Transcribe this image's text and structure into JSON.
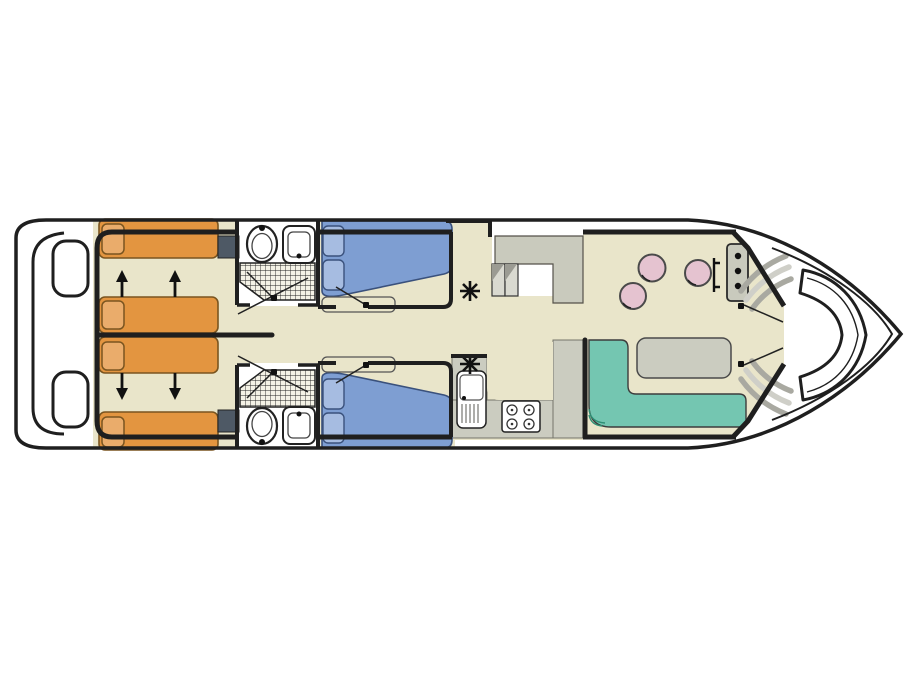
{
  "diagram": {
    "kind": "houseboat-floor-plan",
    "orientation": "bow-right",
    "areas": [
      {
        "name": "stern-swim-platform",
        "features": [
          "platform-inner-rail",
          "boarding-pads"
        ]
      },
      {
        "name": "aft-twin-cabins",
        "bed_count": 4,
        "bed_color_key": "bed_orange",
        "features": [
          "sliding-bed-arrows-up",
          "sliding-bed-arrows-down",
          "wardrobe-top",
          "wardrobe-bottom",
          "center-partition"
        ]
      },
      {
        "name": "bathrooms",
        "count": 2,
        "fixtures": [
          "toilet",
          "washbasin",
          "shower-hatched"
        ]
      },
      {
        "name": "mid-double-cabins",
        "bed_count": 2,
        "bed_color_key": "bed_blue",
        "features": [
          "stacked-pillows",
          "foot-bench",
          "heater-asterisk-symbol"
        ]
      },
      {
        "name": "side-boarding-deck",
        "features": [
          "two-steps-down",
          "raised-gray-deck"
        ]
      },
      {
        "name": "galley",
        "fixtures": [
          "sink-with-drainer",
          "four-burner-stove",
          "u-shaped-counter",
          "heater-asterisk-symbol"
        ]
      },
      {
        "name": "salon",
        "stool_count": 3,
        "fixtures": [
          "helm-console-three-gauges",
          "steering-wheel-bar",
          "round-stools",
          "l-shaped-sofa",
          "rectangular-table"
        ]
      },
      {
        "name": "bow-deck",
        "fixtures": [
          "curved-crescent-bench",
          "port-boarding-steps",
          "starboard-boarding-steps",
          "two-doors"
        ]
      }
    ]
  },
  "colors": {
    "page_bg": "#ffffff",
    "hull_fill": "#ffffff",
    "line": "#1f1f1f",
    "floor_beige": "#e9e5ca",
    "deck_gray": "#c9cabd",
    "counter_gray": "#cbccc0",
    "bed_orange": "#e39540",
    "pillow_orange": "#eaac6b",
    "bed_blue": "#7e9ed2",
    "pillow_blue": "#a6bce1",
    "sofa_teal": "#74c6b1",
    "sofa_edge": "#2f8f75",
    "stool_pink": "#e5c3d0",
    "table_gray": "#cbccc0",
    "wardrobe_slate": "#4e5965",
    "step_gray": "#a9a9a1"
  }
}
